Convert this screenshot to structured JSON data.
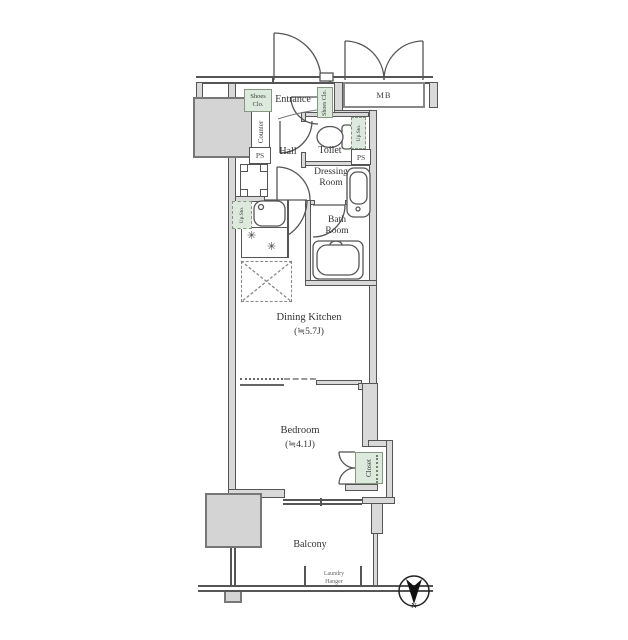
{
  "plan": {
    "rooms": {
      "entrance": "Entrance",
      "hall": "Hall",
      "toilet": "Toilet",
      "dressing1": "Dressing",
      "dressing2": "Room",
      "bath1": "Bath",
      "bath2": "Room",
      "dk": "Dining Kitchen",
      "dk_size": "(≒5.7J)",
      "bedroom": "Bedroom",
      "bedroom_size": "(≒4.1J)",
      "balcony": "Balcony"
    },
    "fixtures": {
      "mb": "MB",
      "ps_left": "PS",
      "ps_right": "PS",
      "counter": "Counter",
      "shoes_top": "Shoes Clo.",
      "shoes_side": "Shoes Clo.",
      "upsto_toilet": "Up.Sto.",
      "upsto_kitchen": "Up.Sto.",
      "closet": "Closet"
    },
    "annotations": {
      "laundry1": "Laundry",
      "laundry2": "Hanger",
      "north": "N"
    },
    "icons": {
      "burner": "✳"
    },
    "colors": {
      "wall_line": "#555555",
      "wall_fill": "#d9d9d9",
      "block_fill": "#d4d4d4",
      "storage_fill": "#dde9dc",
      "storage_border": "#84987f"
    }
  }
}
